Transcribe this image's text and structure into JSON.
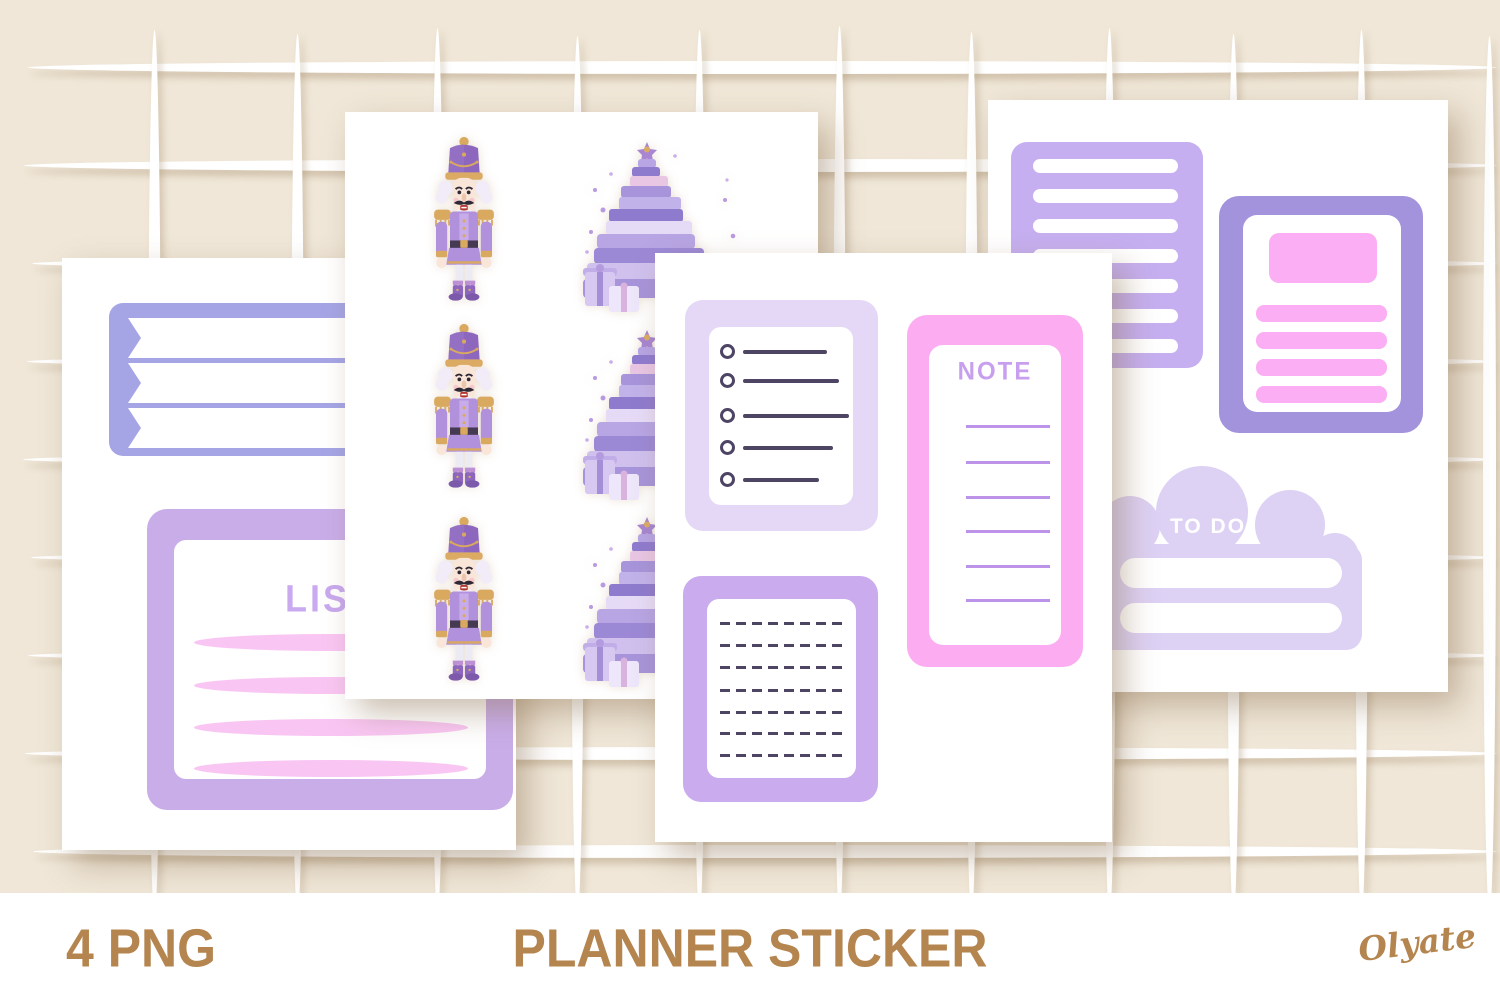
{
  "product": {
    "format_label": "4 PNG",
    "title": "PLANNER STICKER",
    "brand": "Olyate"
  },
  "sheets": {
    "sheet1": {
      "list_label": "LIST"
    },
    "sheet3": {
      "note_label": "NOTE"
    },
    "sheet4": {
      "todo_label": "TO DO"
    }
  },
  "colors": {
    "bg_beige": "#f0e7d8",
    "grid_white": "#ffffff",
    "brown": "#b5854f",
    "periwinkle": "#a5a5e6",
    "lavender_list": "#c9ade9",
    "list_text": "#c9a9ef",
    "pink_oval": "#f9c6f3",
    "checklist_border": "#e5d8f7",
    "ink": "#4e4565",
    "note_pink": "#fcadf2",
    "note_title": "#c79fee",
    "note_line": "#bd92e9",
    "dashed_border": "#c9abee",
    "stripe_lav": "#c6aff0",
    "card_purple": "#a392dc",
    "card_pink": "#fcaef4",
    "cloud": "#ddd1f4"
  }
}
